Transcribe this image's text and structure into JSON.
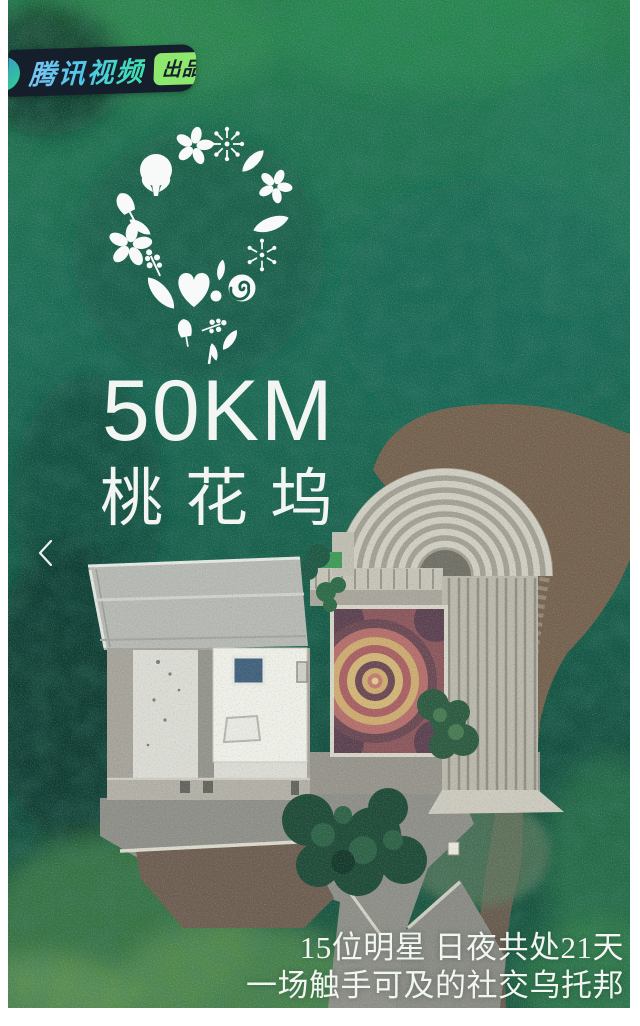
{
  "poster": {
    "publisher_badge": {
      "brand": "腾讯视频",
      "chip": "出品"
    },
    "logo_title": {
      "km": "50KM",
      "name": "桃花坞"
    },
    "nav": {
      "prev_icon": "chevron-left"
    },
    "tagline": {
      "line1": "15位明星 日夜共处21天",
      "line2": "一场触手可及的社交乌托邦"
    },
    "colors": {
      "badge_bg": "#151e2b",
      "brand_blue": "#5fb7ee",
      "brand_teal": "#43dfb0",
      "chip_green": "#8fe86e",
      "chip_text": "#15202c",
      "forest_dark": "#154a3c",
      "forest_light": "#26804a",
      "stone_light": "#cfccc1",
      "dirt_brown": "#75614e",
      "plot_plum": "#6b4853",
      "plot_rose": "#b46e6b",
      "plot_gold": "#cdab70",
      "text_white": "#f2f5f1"
    }
  }
}
